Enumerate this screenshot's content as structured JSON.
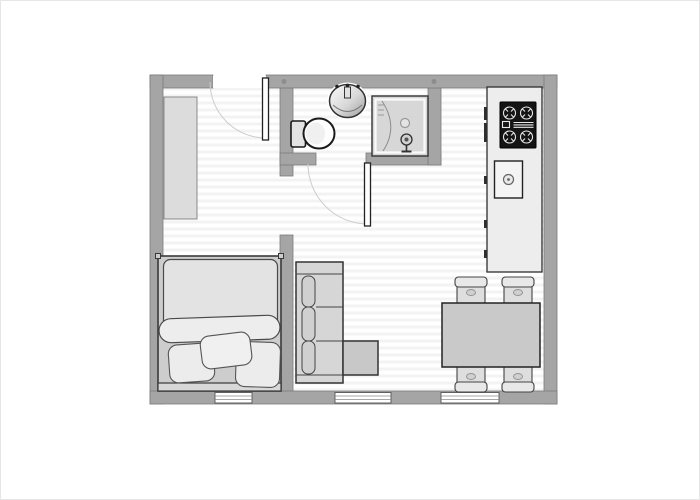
{
  "plan": {
    "title": "studio-apartment-floor-plan",
    "rooms": [
      {
        "name": "bedroom",
        "items": [
          "wardrobe",
          "double-bed",
          "blanket-roll",
          "pillows-x3",
          "window"
        ]
      },
      {
        "name": "bathroom",
        "items": [
          "washbasin",
          "toilet",
          "shower-cabin",
          "door"
        ]
      },
      {
        "name": "kitchen",
        "items": [
          "counter-with-handles",
          "stove-cooktop",
          "kitchen-sink"
        ]
      },
      {
        "name": "living-dining-area",
        "items": [
          "corner-sofa",
          "dining-table",
          "chairs-x4",
          "windows-x2"
        ]
      }
    ],
    "doors_count": 2,
    "windows_count": 3,
    "open-passages_count": 1
  },
  "palette": {
    "background": "#ffffff",
    "wall": "#a5a5a5",
    "wall_edge": "#7c7c7c",
    "floor_stripe": "#f3f3f3",
    "outline": "#333333",
    "furniture_light": "#ececec",
    "furniture_mid": "#c9c9c9",
    "counter": "#ededed",
    "table": "#c9c9c9",
    "sofa": "#d6d6d6",
    "stove_black": "#141414",
    "duvet": "#e3e3e3",
    "arc": "#cccccc",
    "white": "#ffffff"
  }
}
